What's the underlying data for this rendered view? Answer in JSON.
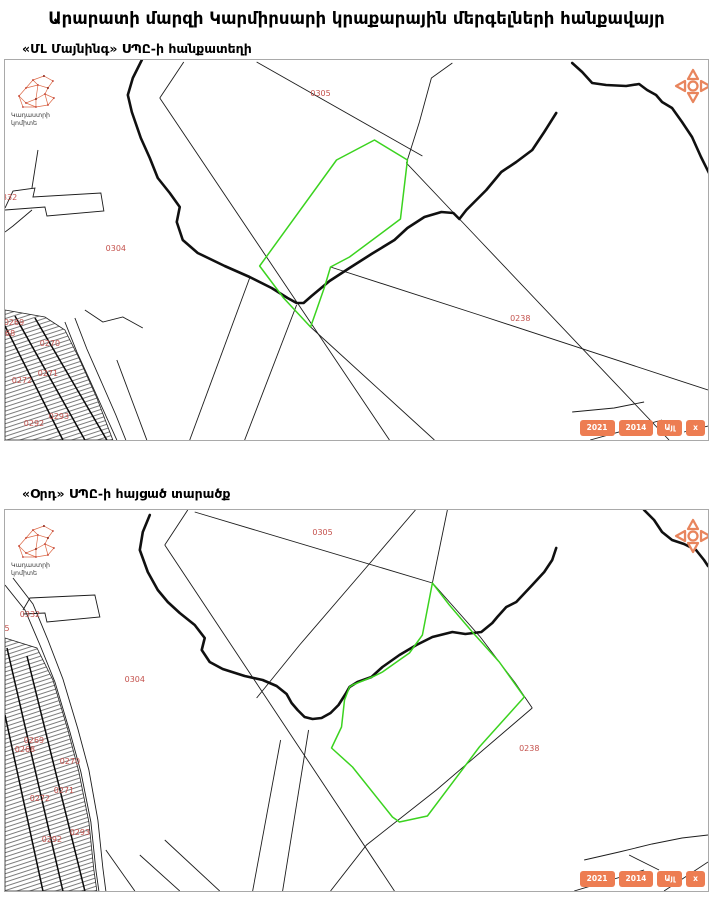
{
  "page": {
    "title": "Արարատի մարզի Կարմիրսարի կրաքարային մերգելների հանքավայր"
  },
  "logo": {
    "line1": "Կադաստրի",
    "line2": "կոմիտե"
  },
  "icons": {
    "pan_control": "dpad-four-arrows",
    "logo_mark": "network-graph-armenia"
  },
  "colors": {
    "parcel_label_red": "#c4524d",
    "highlight_green": "#3bd31f",
    "accent_orange": "#ed7d52",
    "line_black": "#1c1c1c",
    "border_gray": "#a9a9a9"
  },
  "maps": [
    {
      "subtitle": "«ՄԼ Մայնինգ» ՍՊԸ-ի հանքատեղի",
      "buttons": [
        "2021",
        "2014",
        "Այլ",
        "x"
      ],
      "parcel_labels": [
        {
          "text": "0305",
          "x": 316,
          "y": 36
        },
        {
          "text": "0304",
          "x": 111,
          "y": 191
        },
        {
          "text": "0238",
          "x": 516,
          "y": 261
        },
        {
          "text": "0332",
          "x": 2,
          "y": 140
        },
        {
          "text": "0269",
          "x": 9,
          "y": 265
        },
        {
          "text": "0268",
          "x": 0,
          "y": 276
        },
        {
          "text": "0270",
          "x": 45,
          "y": 286
        },
        {
          "text": "0271",
          "x": 43,
          "y": 316
        },
        {
          "text": "0272",
          "x": 17,
          "y": 323
        },
        {
          "text": "0293",
          "x": 54,
          "y": 359
        },
        {
          "text": "0292",
          "x": 29,
          "y": 366
        }
      ]
    },
    {
      "subtitle": "«Օրդ» ՍՊԸ-ի հայցած տարածք",
      "buttons": [
        "2021",
        "2014",
        "Այլ",
        "x"
      ],
      "parcel_labels": [
        {
          "text": "0305",
          "x": 318,
          "y": 25
        },
        {
          "text": "0304",
          "x": 130,
          "y": 172
        },
        {
          "text": "0238",
          "x": 525,
          "y": 241
        },
        {
          "text": "0332",
          "x": 25,
          "y": 107
        },
        {
          "text": "5",
          "x": 2,
          "y": 121
        },
        {
          "text": "0269",
          "x": 29,
          "y": 233
        },
        {
          "text": "0268",
          "x": 20,
          "y": 242
        },
        {
          "text": "0270",
          "x": 65,
          "y": 254
        },
        {
          "text": "0271",
          "x": 59,
          "y": 283
        },
        {
          "text": "0272",
          "x": 35,
          "y": 291
        },
        {
          "text": "0293",
          "x": 75,
          "y": 325
        },
        {
          "text": "0292",
          "x": 47,
          "y": 332
        }
      ]
    }
  ]
}
